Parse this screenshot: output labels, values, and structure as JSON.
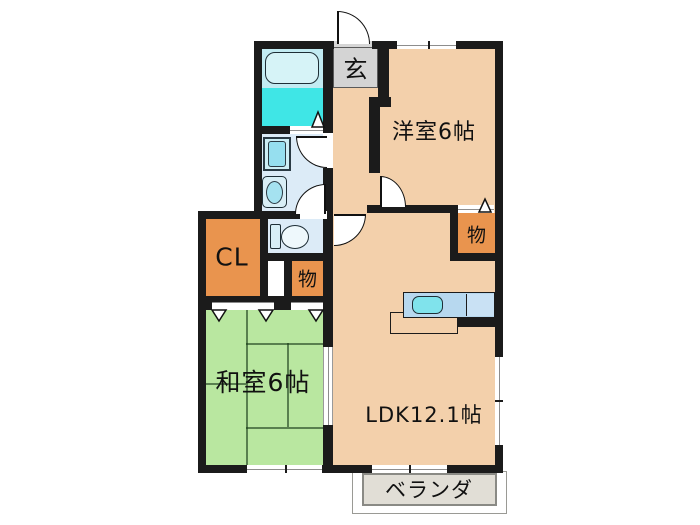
{
  "floorplan": {
    "rooms": {
      "genkan": {
        "label": "玄"
      },
      "western_room": {
        "label": "洋室6帖"
      },
      "storage_upper": {
        "label": "物"
      },
      "storage_lower": {
        "label": "物"
      },
      "closet": {
        "label": "CL"
      },
      "japanese_room": {
        "label": "和室6帖"
      },
      "ldk": {
        "label": "LDK12.1帖"
      },
      "veranda": {
        "label": "ベランダ"
      }
    },
    "colors": {
      "wall": "#1b1b1b",
      "floor_peach": "#f3d0ab",
      "tatami_green": "#b9e7a0",
      "storage_orange": "#e9944e",
      "bath_bright_cyan": "#3fe6e6",
      "bath_light_cyan": "#c2ebf2",
      "wet_area_blue": "#dcebf7",
      "counter_blue": "#b7d8ef",
      "sink_cyan": "#80e3ec",
      "genkan_gray": "#d4d4d4",
      "veranda_gray": "#e1ded6"
    }
  }
}
